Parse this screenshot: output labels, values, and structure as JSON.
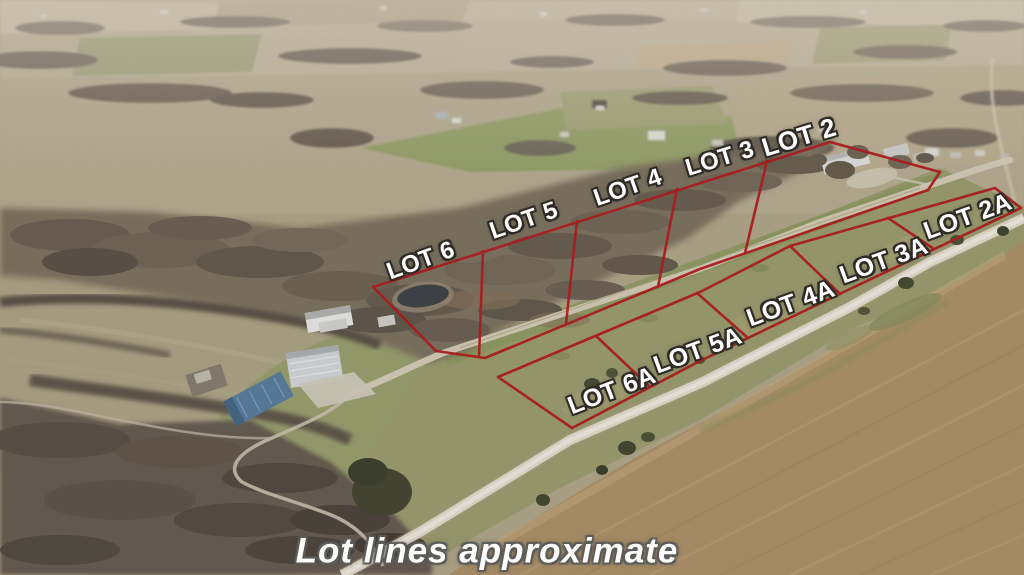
{
  "photo": {
    "type": "aerial-drone-photograph",
    "scene": "rural acreage with surveyed lot line overlay"
  },
  "overlay": {
    "lot_line_color": "#a81e1e",
    "label_color": "#ffffff",
    "label_outline_color": "#2f2b26"
  },
  "lots": [
    {
      "id": "lot-6",
      "label": "LOT 6"
    },
    {
      "id": "lot-5",
      "label": "LOT 5"
    },
    {
      "id": "lot-4",
      "label": "LOT 4"
    },
    {
      "id": "lot-3",
      "label": "LOT 3"
    },
    {
      "id": "lot-2",
      "label": "LOT 2"
    },
    {
      "id": "lot-6a",
      "label": "LOT 6A"
    },
    {
      "id": "lot-5a",
      "label": "LOT 5A"
    },
    {
      "id": "lot-4a",
      "label": "LOT 4A"
    },
    {
      "id": "lot-3a",
      "label": "LOT 3A"
    },
    {
      "id": "lot-2a",
      "label": "LOT 2A"
    }
  ],
  "watermark": {
    "text": "Lot lines approximate"
  }
}
